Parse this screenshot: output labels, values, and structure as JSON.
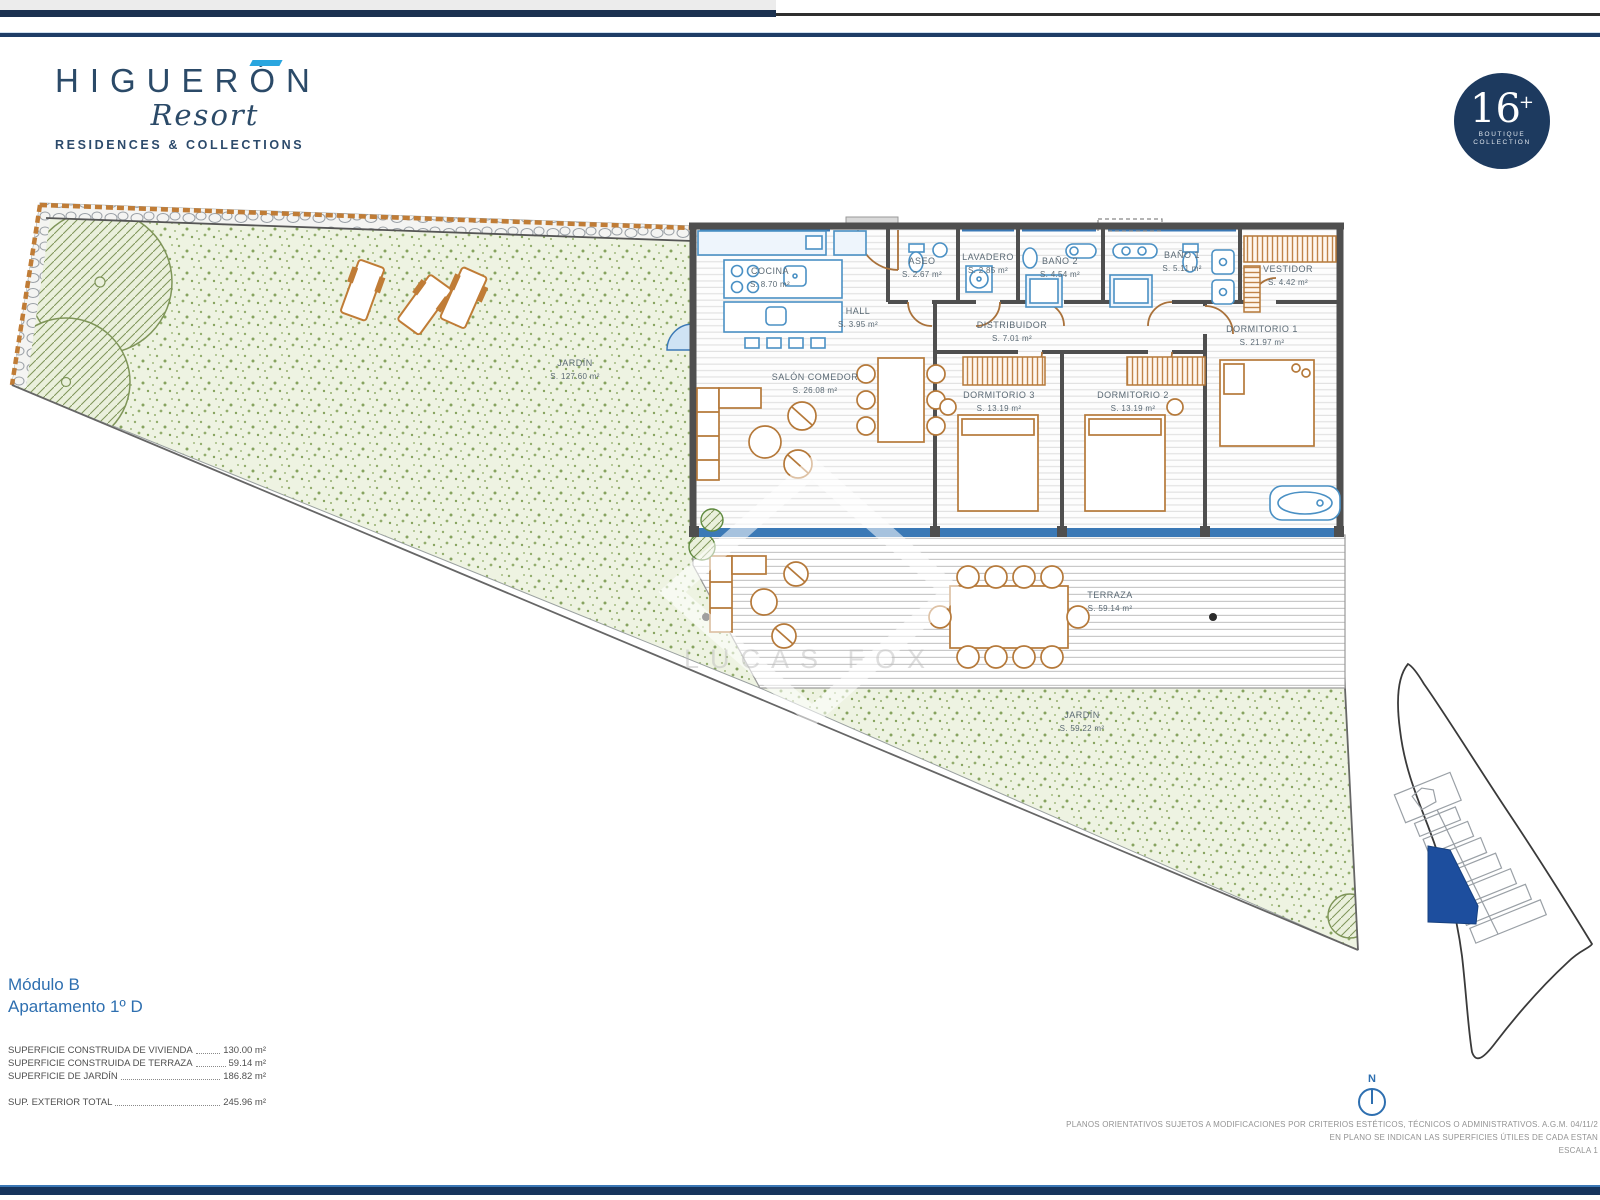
{
  "logo": {
    "title": "HIGUERÓN",
    "script": "Resort",
    "tagline": "RESIDENCES & COLLECTIONS"
  },
  "badge": {
    "number": "16",
    "plus": "+",
    "line1": "BOUTIQUE",
    "line2": "COLLECTION"
  },
  "plan": {
    "rooms": [
      {
        "name": "COCINA",
        "area": "S. 8.70 m²"
      },
      {
        "name": "HALL",
        "area": "S. 3.95 m²"
      },
      {
        "name": "ASEO",
        "area": "S. 2.67 m²"
      },
      {
        "name": "LAVADERO",
        "area": "S. 2.85 m²"
      },
      {
        "name": "BAÑO 2",
        "area": "S. 4.54 m²"
      },
      {
        "name": "BAÑO 1",
        "area": "S. 5.11 m²"
      },
      {
        "name": "VESTIDOR",
        "area": "S. 4.42 m²"
      },
      {
        "name": "DISTRIBUIDOR",
        "area": "S. 7.01 m²"
      },
      {
        "name": "DORMITORIO 1",
        "area": "S. 21.97 m²"
      },
      {
        "name": "DORMITORIO 2",
        "area": "S. 13.19 m²"
      },
      {
        "name": "DORMITORIO 3",
        "area": "S. 13.19 m²"
      },
      {
        "name": "SALÓN COMEDOR",
        "area": "S. 26.08 m²"
      },
      {
        "name": "TERRAZA",
        "area": "S. 59.14 m²"
      },
      {
        "name": "JARDÍN",
        "area": "S. 127.60 m²"
      },
      {
        "name": "JARDÍN",
        "area": "S. 59.22 m²"
      }
    ],
    "north_label": "N"
  },
  "title_block": {
    "module": "Módulo B",
    "apartment": "Apartamento 1º D"
  },
  "surfaces": {
    "rows": [
      {
        "label": "SUPERFICIE CONSTRUIDA DE VIVIENDA",
        "value": "130.00 m²"
      },
      {
        "label": "SUPERFICIE CONSTRUIDA DE TERRAZA",
        "value": "59.14 m²"
      },
      {
        "label": "SUPERFICIE DE JARDÍN",
        "value": "186.82 m²"
      }
    ],
    "total": {
      "label": "SUP. EXTERIOR TOTAL",
      "value": "245.96 m²"
    }
  },
  "footer": {
    "disclaimer_line1": "PLANOS ORIENTATIVOS SUJETOS A MODIFICACIONES POR CRITERIOS ESTÉTICOS, TÉCNICOS O ADMINISTRATIVOS. A.G.M. 04/11/2",
    "disclaimer_line2": "EN PLANO SE INDICAN LAS SUPERFICIES ÚTILES DE CADA ESTAN",
    "scale": "ESCALA 1"
  },
  "watermark": "LUCAS FOX",
  "colors": {
    "navy": "#1d3a5f",
    "logo_blue": "#2b4a68",
    "accent_cyan": "#2aa6df",
    "plan_blue": "#3b79b6",
    "tan": "#b5793a",
    "wall_grey": "#4f4f4f",
    "garden_green": "#edf3e2",
    "label_grey": "#5b6a75",
    "unit_blue": "#1d4e9e"
  }
}
